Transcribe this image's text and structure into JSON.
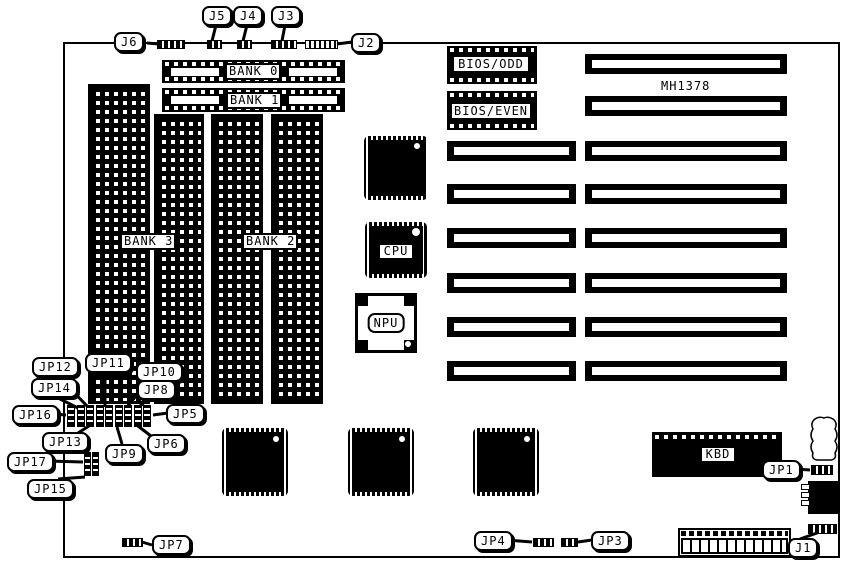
{
  "board": {
    "model": "MH1378",
    "memory_banks": {
      "bank0": "BANK 0",
      "bank1": "BANK 1",
      "bank2": "BANK 2",
      "bank3": "BANK 3"
    },
    "chips": {
      "bios_odd": "BIOS/ODD",
      "bios_even": "BIOS/EVEN",
      "cpu": "CPU",
      "npu": "NPU",
      "kbd": "KBD"
    },
    "connectors": {
      "j1": "J1",
      "j2": "J2",
      "j3": "J3",
      "j4": "J4",
      "j5": "J5",
      "j6": "J6"
    },
    "jumpers": {
      "jp1": "JP1",
      "jp3": "JP3",
      "jp4": "JP4",
      "jp5": "JP5",
      "jp6": "JP6",
      "jp7": "JP7",
      "jp8": "JP8",
      "jp9": "JP9",
      "jp10": "JP10",
      "jp11": "JP11",
      "jp12": "JP12",
      "jp13": "JP13",
      "jp14": "JP14",
      "jp15": "JP15",
      "jp16": "JP16",
      "jp17": "JP17"
    },
    "colors": {
      "ink": "#000000",
      "paper": "#ffffff"
    }
  }
}
